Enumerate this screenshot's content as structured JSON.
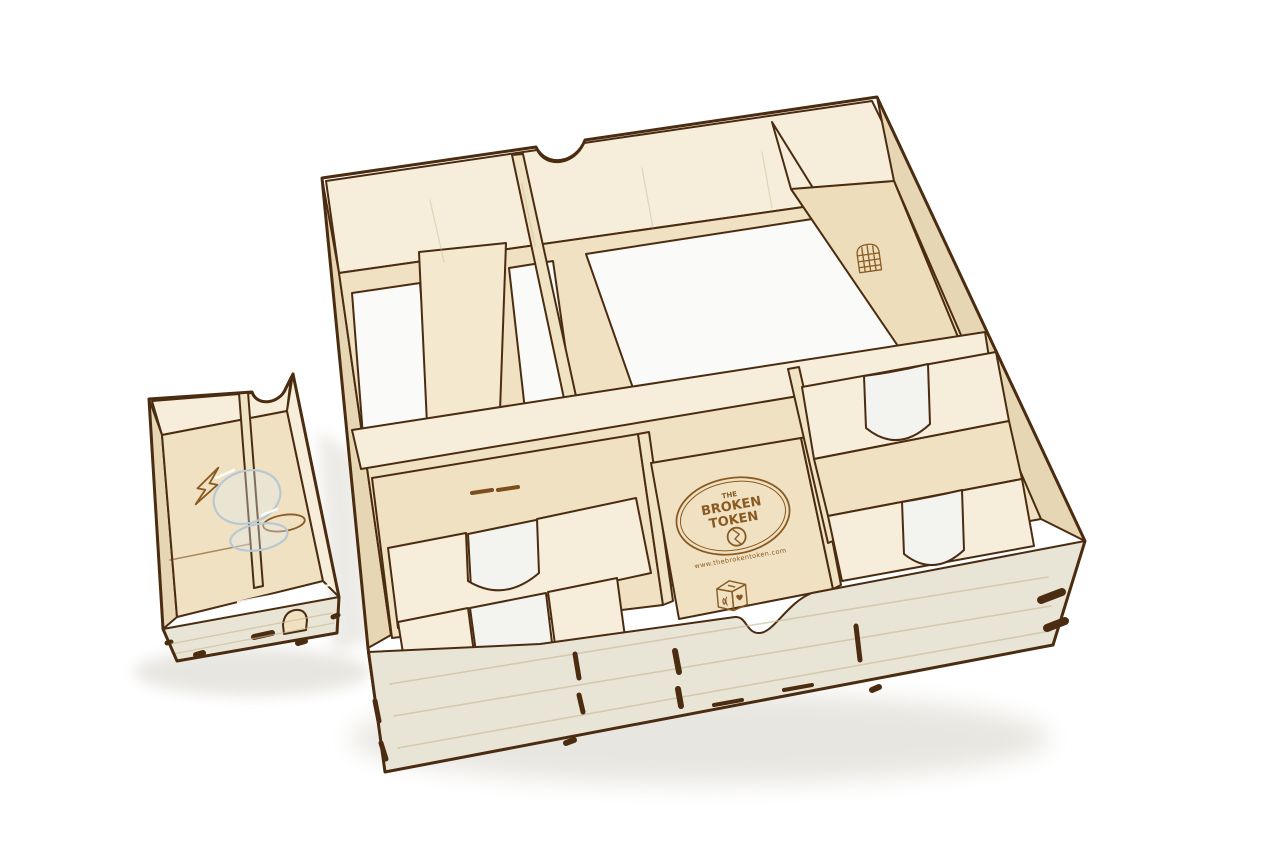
{
  "image": {
    "type": "product-photo",
    "subject": "Laser-cut birch plywood board game box organizer insert with card bins and trays, shown with a small accessory tray with clear acrylic pieces, on a white studio background",
    "objects": [
      {
        "id": "accessory-tray",
        "label": "small wooden accessory tray",
        "position": "front left"
      },
      {
        "id": "main-organizer",
        "label": "large square game box organizer",
        "position": "center right"
      }
    ]
  },
  "engravings": {
    "logo_text_top": "THE",
    "logo_text_main": "BROKEN",
    "logo_text_sub": "TOKEN",
    "logo_url": "www.thebrokentoken.com",
    "icons": [
      {
        "name": "portcullis-icon",
        "location": "back-right tray floor of main organizer"
      },
      {
        "name": "dice-heart-icon",
        "location": "front of center bin floor of main organizer"
      },
      {
        "name": "lightning-bolt-icon",
        "location": "accessory tray floor, left compartment"
      },
      {
        "name": "coin-oval-icon",
        "location": "accessory tray floor, right compartment"
      }
    ]
  },
  "colors": {
    "paper_white": "#ffffff",
    "opening_white": "#fafaf8",
    "silver_white": "#f3f3f0",
    "wood_floor": "#efe1c1",
    "wood_floor_warm": "#eeddba",
    "wood_wall_light": "#f6eedb",
    "wood_wall_mid": "#e6d6b4",
    "wood_wall_warm": "#efe3c4",
    "wood_strip": "#f4e9cf",
    "wood_exterior": "#e9e5d6",
    "edge_burn": "#4b2c10",
    "edge_soft": "#7c4e1e",
    "engraving": "#8a5a22",
    "grain": "#c9b892",
    "shadow": "#e4e2dc",
    "acrylic_edge": "#b9c8d2",
    "acrylic_fill": "rgba(226,236,243,0.35)",
    "acrylic_glint": "#ffffff"
  }
}
